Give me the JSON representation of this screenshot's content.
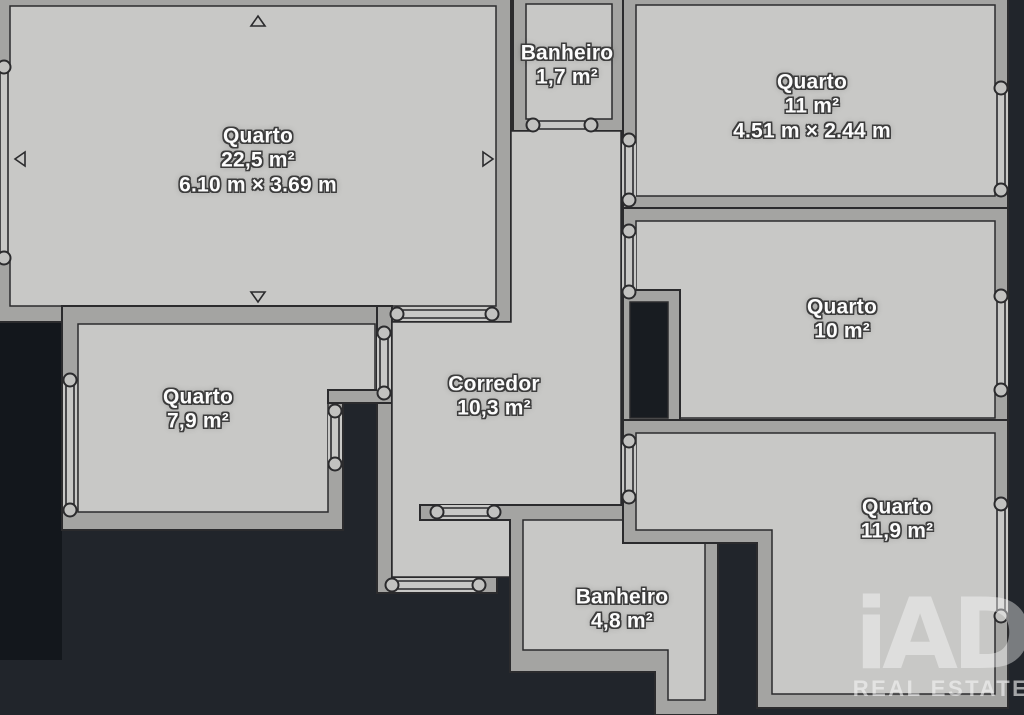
{
  "title": "Floor plan",
  "colors": {
    "background": "#21252b",
    "floor": "#c8c8c6",
    "wall": "#a4a4a2",
    "outline": "#2b2b2d",
    "label_text": "#fcfcfc"
  },
  "rooms": [
    {
      "id": "quarto-22",
      "name": "Quarto",
      "area": "22,5 m²",
      "dimensions": "6.10 m × 3.69 m"
    },
    {
      "id": "banheiro-17",
      "name": "Banheiro",
      "area": "1,7 m²"
    },
    {
      "id": "quarto-11",
      "name": "Quarto",
      "area": "11 m²",
      "dimensions": "4.51 m × 2.44 m"
    },
    {
      "id": "quarto-10",
      "name": "Quarto",
      "area": "10 m²"
    },
    {
      "id": "quarto-79",
      "name": "Quarto",
      "area": "7,9 m²"
    },
    {
      "id": "corredor",
      "name": "Corredor",
      "area": "10,3 m²"
    },
    {
      "id": "quarto-119",
      "name": "Quarto",
      "area": "11,9 m²"
    },
    {
      "id": "banheiro-48",
      "name": "Banheiro",
      "area": "4,8 m²"
    }
  ],
  "watermark": {
    "logo": "iAD",
    "subtitle": "REAL ESTATE"
  }
}
